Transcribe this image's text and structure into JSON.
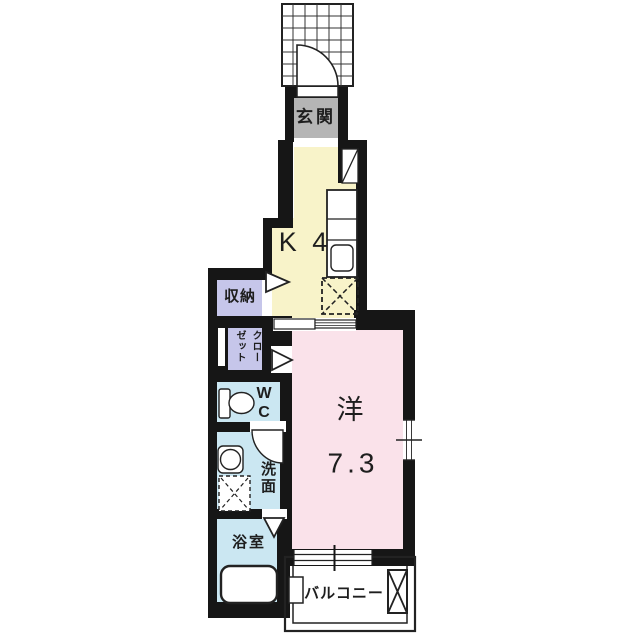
{
  "plan": {
    "entrance_label": "玄関",
    "kitchen_label": "K 4",
    "storage_label": "収納",
    "closet_label": "クローゼット",
    "wc_label": "W\nC",
    "washroom_label": "洗面",
    "bathroom_label": "浴室",
    "western_room_label": "洋",
    "western_room_size": "7.3",
    "balcony_label": "バルコニー"
  },
  "colors": {
    "wall": "#161616",
    "line": "#222222",
    "kitchen": "#f8f3c9",
    "western_room": "#fae2ea",
    "storage": "#c6c6ea",
    "closet": "#c6c6ea",
    "wet_area": "#cbe7f2",
    "entrance": "#b5b5b5",
    "background": "#ffffff"
  }
}
